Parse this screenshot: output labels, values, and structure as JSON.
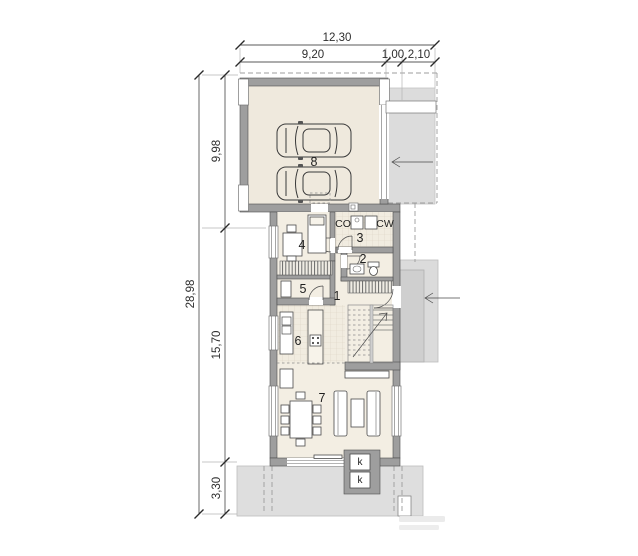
{
  "page": {
    "background": "#FFFFFF"
  },
  "dimensions": {
    "top": {
      "total": "12,30",
      "seg1": "9,20",
      "seg2": "1,00",
      "seg3": "2,10"
    },
    "left": {
      "total": "28,98",
      "seg1": "9,98",
      "seg2": "15,70",
      "seg3": "3,30"
    }
  },
  "rooms": {
    "r1": {
      "label": "1"
    },
    "r2": {
      "label": "2"
    },
    "r3": {
      "label": "3"
    },
    "r4": {
      "label": "4"
    },
    "r5": {
      "label": "5"
    },
    "r6": {
      "label": "6"
    },
    "r7": {
      "label": "7"
    },
    "r8": {
      "label": "8"
    }
  },
  "annotations": {
    "co": "CO",
    "cw": "CW",
    "k_upper": "k",
    "k_lower": "k"
  },
  "colors": {
    "wall": "#9E9E9E",
    "room_floor": "#F3EEE3",
    "garage_floor": "#EFE9DD",
    "terrace": "#DEDEDE",
    "driveway": "#DCDCDC",
    "porch": "#CFCFCF",
    "dashed_line": "#9C9C9C",
    "dimension_line": "#5A5A5A",
    "text": "#2E2E2E"
  }
}
